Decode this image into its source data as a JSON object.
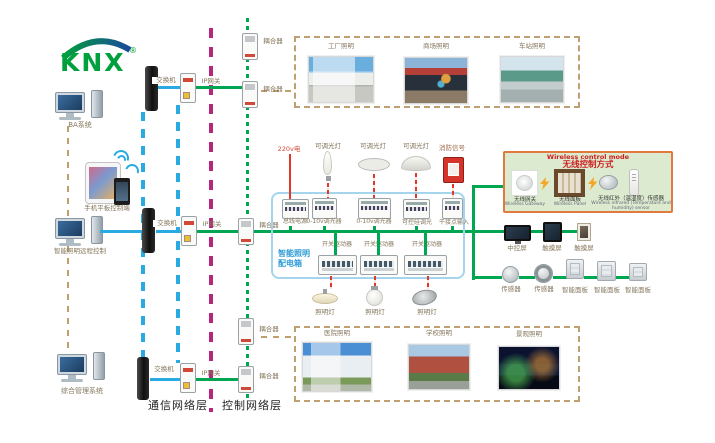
{
  "logo": {
    "text": "KNX",
    "registered": "®"
  },
  "clients": {
    "ba_system": "BA系统",
    "mobile_control": "手机平板控制端",
    "remote_lighting_control": "智能照明远程控制",
    "management_system": "综合管理系统"
  },
  "network": {
    "switch_label": "交换机",
    "ip_gateway_label": "IP网关",
    "coupler_label": "耦合器",
    "communication_layer": "通信网络层",
    "control_layer": "控制网络层"
  },
  "cabinet": {
    "name_line1": "智能照明",
    "name_line2": "配电箱",
    "mains_label": "220v电",
    "dimmable_lamp_label": "可调光灯",
    "fire_signal_label": "消防信号",
    "row1_devices": [
      "总线电源",
      "0-10v调光器",
      "0-10v调光器",
      "可控硅调光",
      "干接点输入"
    ],
    "row2_devices": [
      "开关驱动器",
      "开关驱动器",
      "开关驱动器"
    ],
    "lamp_label": "照明灯"
  },
  "wireless": {
    "title_en": "Wireless control mode",
    "title_zh": "无线控制方式",
    "devices": [
      {
        "zh": "无线网关",
        "en": "Wireless Gateway"
      },
      {
        "zh": "无线面板",
        "en": "Wireless Panel"
      },
      {
        "zh": "无线红外（温湿度）传感器",
        "en_line1": "Wireless infrared (Temperature and",
        "en_line2": "humidity) sensor"
      }
    ]
  },
  "control_devices": {
    "central_screen": "中控屏",
    "touch_screen": "触摸屏",
    "sensor": "传感器",
    "smart_panel": "智能面板"
  },
  "scenes": {
    "top": [
      "工厂照明",
      "商场照明",
      "车站照明"
    ],
    "bottom": [
      "医院照明",
      "学校照明",
      "景观照明"
    ]
  },
  "colors": {
    "bus_green": "#00a651",
    "ip_blue": "#29abe2",
    "backbone_magenta": "#b5267d",
    "link_tan": "#bfa06a",
    "power_red": "#e0392b",
    "cabinet_blue": "#2e9bd6",
    "wireless_border": "#e07a3f",
    "wireless_bg": "#dcead0",
    "wireless_title_red": "#cc2020",
    "knx_green": "#00a03c",
    "knx_blue": "#1b4a9b"
  }
}
